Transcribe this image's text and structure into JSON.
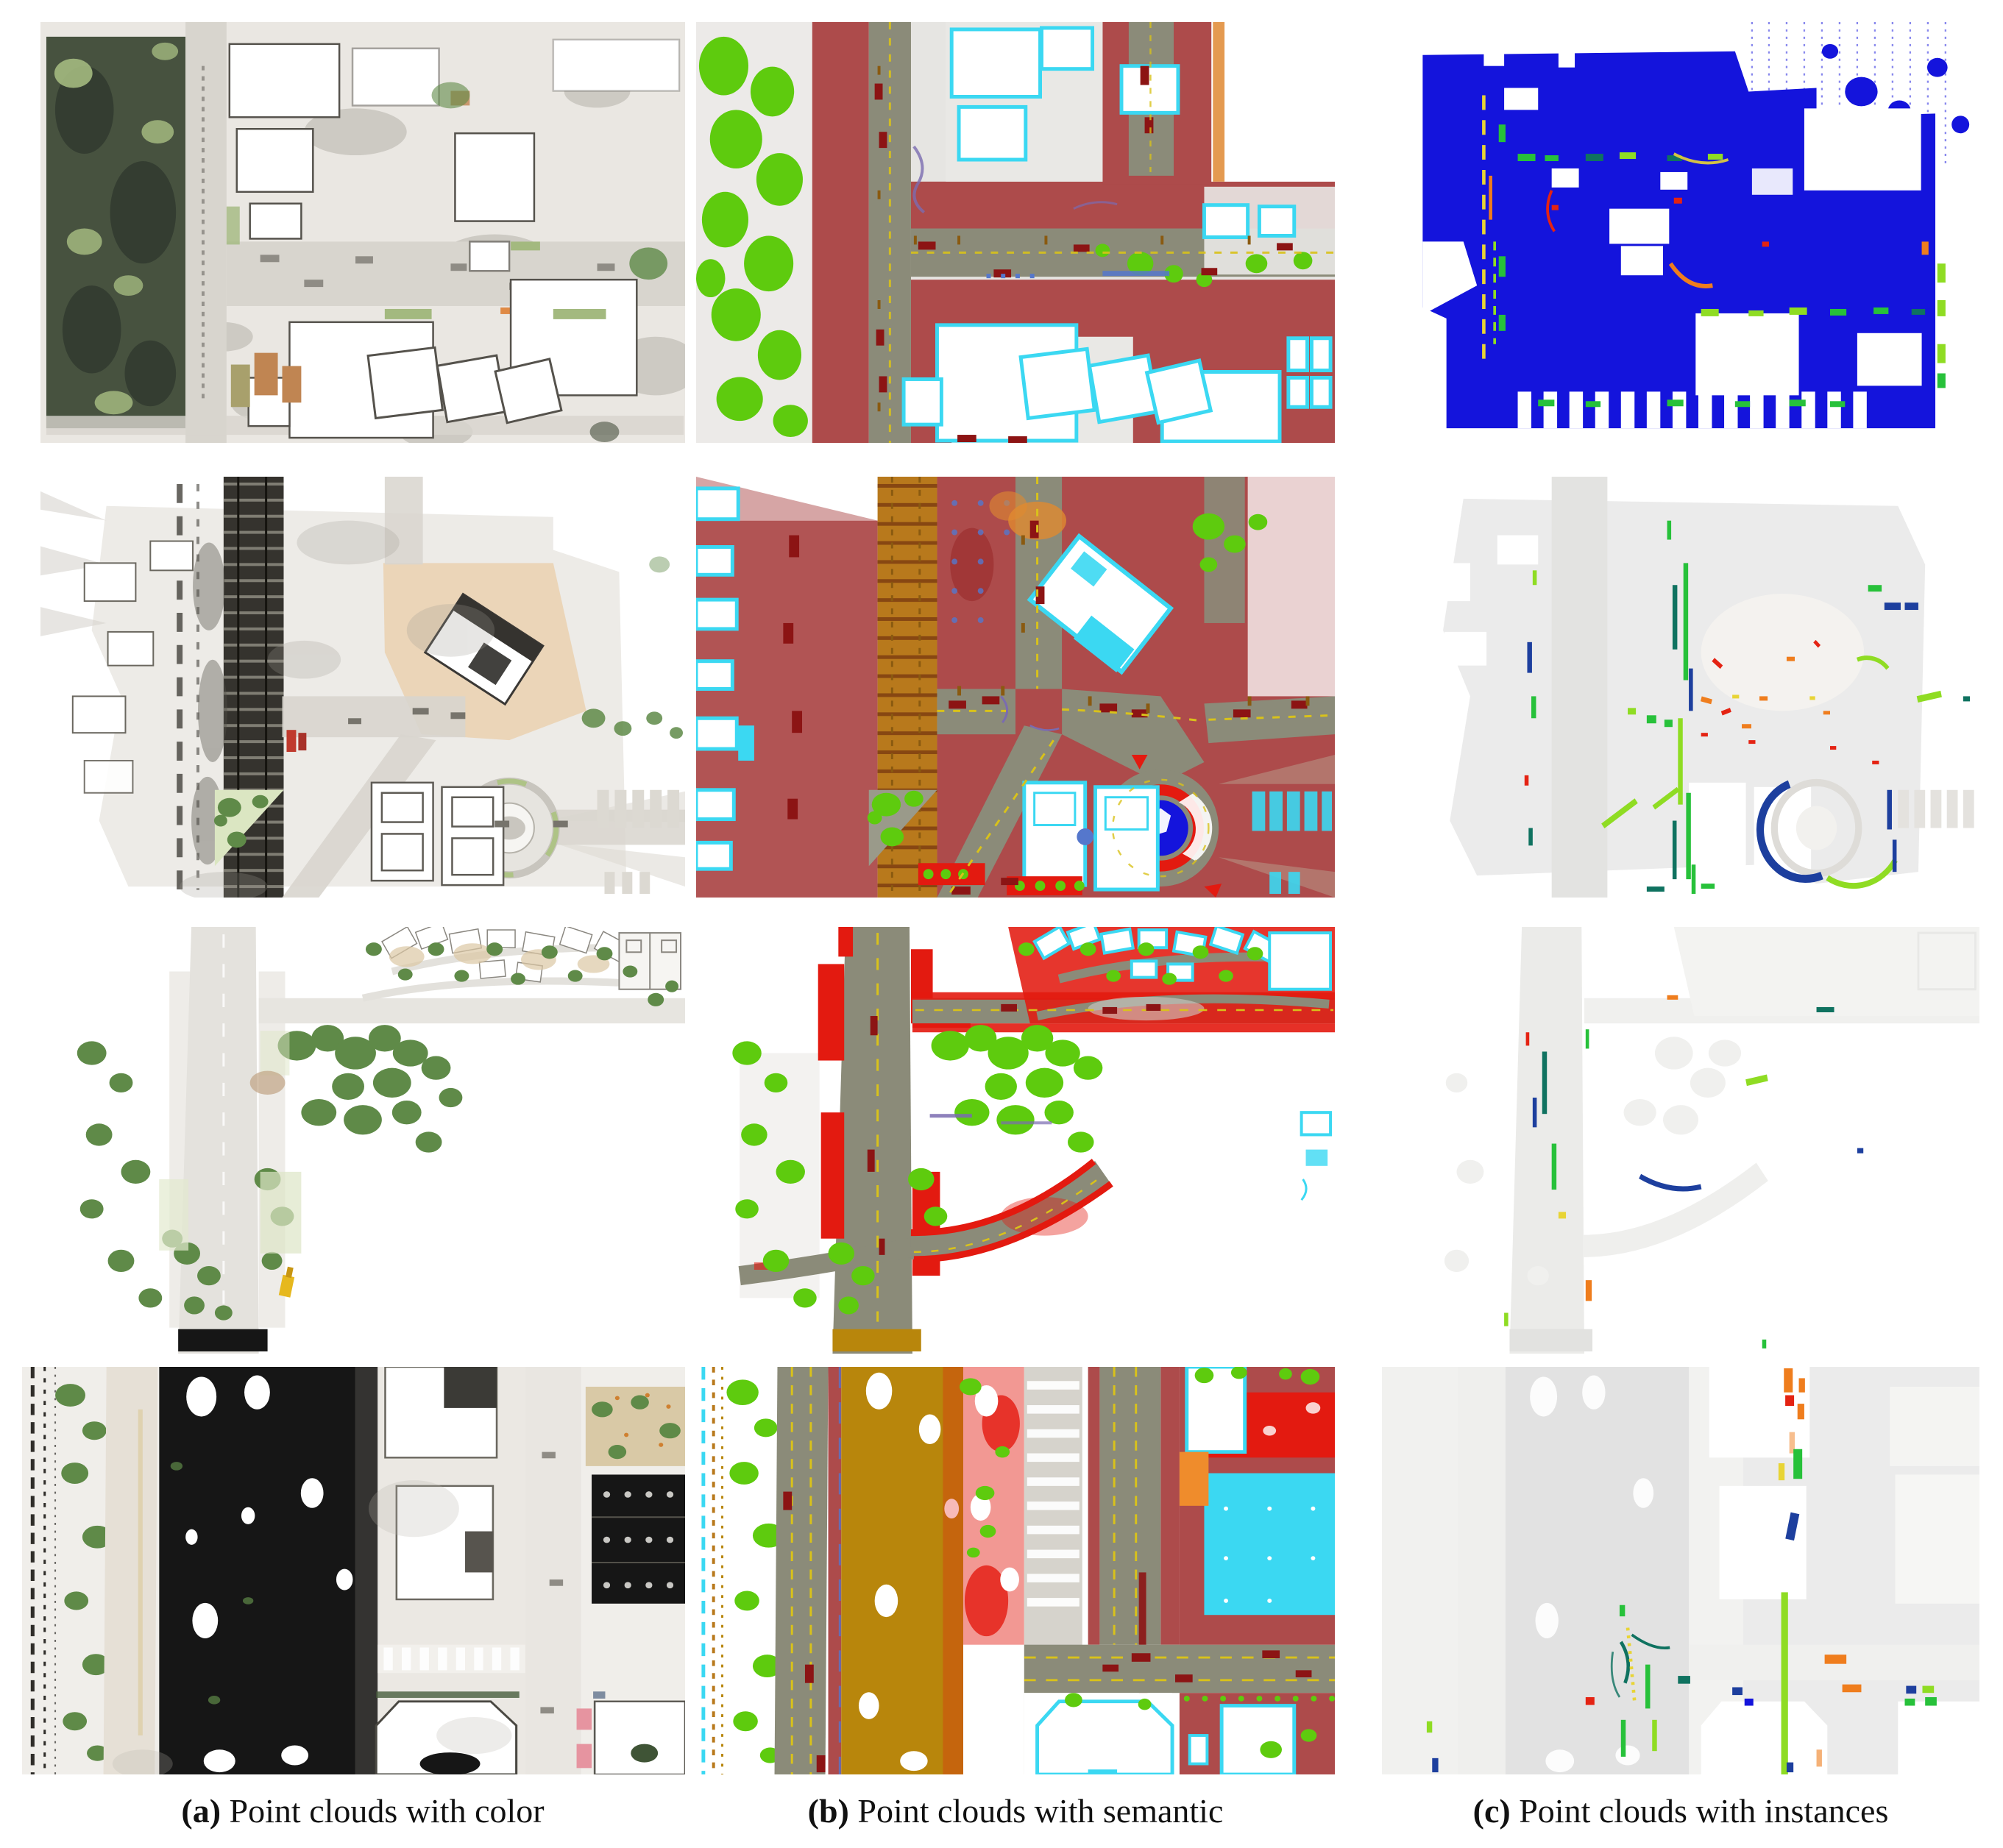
{
  "figure": {
    "type": "point-cloud-comparison-grid",
    "rows": 4,
    "columns": 3,
    "captions": [
      {
        "label": "(a)",
        "text": "Point clouds with color"
      },
      {
        "label": "(b)",
        "text": "Point clouds with semantic"
      },
      {
        "label": "(c)",
        "text": "Point clouds with instances"
      }
    ],
    "panels": [
      {
        "id": "r1a",
        "row": 1,
        "col": "a",
        "modality": "color"
      },
      {
        "id": "r1b",
        "row": 1,
        "col": "b",
        "modality": "semantic"
      },
      {
        "id": "r1c",
        "row": 1,
        "col": "c",
        "modality": "instances"
      },
      {
        "id": "r2a",
        "row": 2,
        "col": "a",
        "modality": "color"
      },
      {
        "id": "r2b",
        "row": 2,
        "col": "b",
        "modality": "semantic"
      },
      {
        "id": "r2c",
        "row": 2,
        "col": "c",
        "modality": "instances"
      },
      {
        "id": "r3a",
        "row": 3,
        "col": "a",
        "modality": "color"
      },
      {
        "id": "r3b",
        "row": 3,
        "col": "b",
        "modality": "semantic"
      },
      {
        "id": "r3c",
        "row": 3,
        "col": "c",
        "modality": "instances"
      },
      {
        "id": "r4a",
        "row": 4,
        "col": "a",
        "modality": "color"
      },
      {
        "id": "r4b",
        "row": 4,
        "col": "b",
        "modality": "semantic"
      },
      {
        "id": "r4c",
        "row": 4,
        "col": "c",
        "modality": "instances"
      }
    ]
  },
  "palette": {
    "ground": "#eae7e2",
    "road_light": "#d8d5ce",
    "shadow_cloud": "#8f8b84",
    "ink": "#161616",
    "tree_dark": "#47523f",
    "tree_light": "#a3b97f",
    "tree_natural": "#5f8a48",
    "tree_semantic": "#5ecb0e",
    "peach": "#ead2b4",
    "tan_roof": "#c08552",
    "sem_ground": "#e6e5e2",
    "sem_road": "#8b8b79",
    "sem_sidewalk": "#ad4b4b",
    "sem_red": "#e31a10",
    "sem_building_cyan": "#3bd8f2",
    "sem_rail_orange": "#b8791c",
    "sem_rail_mustard": "#b8860c",
    "sem_car_darkred": "#8c1414",
    "sem_lane_yellow": "#d9c21a",
    "sem_pole_brown": "#8a5a10",
    "sem_marking_blue": "#5577cc",
    "sem_purple": "#7a6bb0",
    "inst_blue": "#1414dc",
    "inst_navy": "#1d3f9e",
    "inst_teal": "#0f7260",
    "inst_green": "#27c13a",
    "inst_lime": "#8fdc23",
    "inst_orange": "#ef7d1d",
    "inst_red": "#e42313",
    "inst_yellow": "#e8d435",
    "ghost": "#ebebeb",
    "ghost_dark": "#e2e2e2",
    "white": "#ffffff"
  }
}
